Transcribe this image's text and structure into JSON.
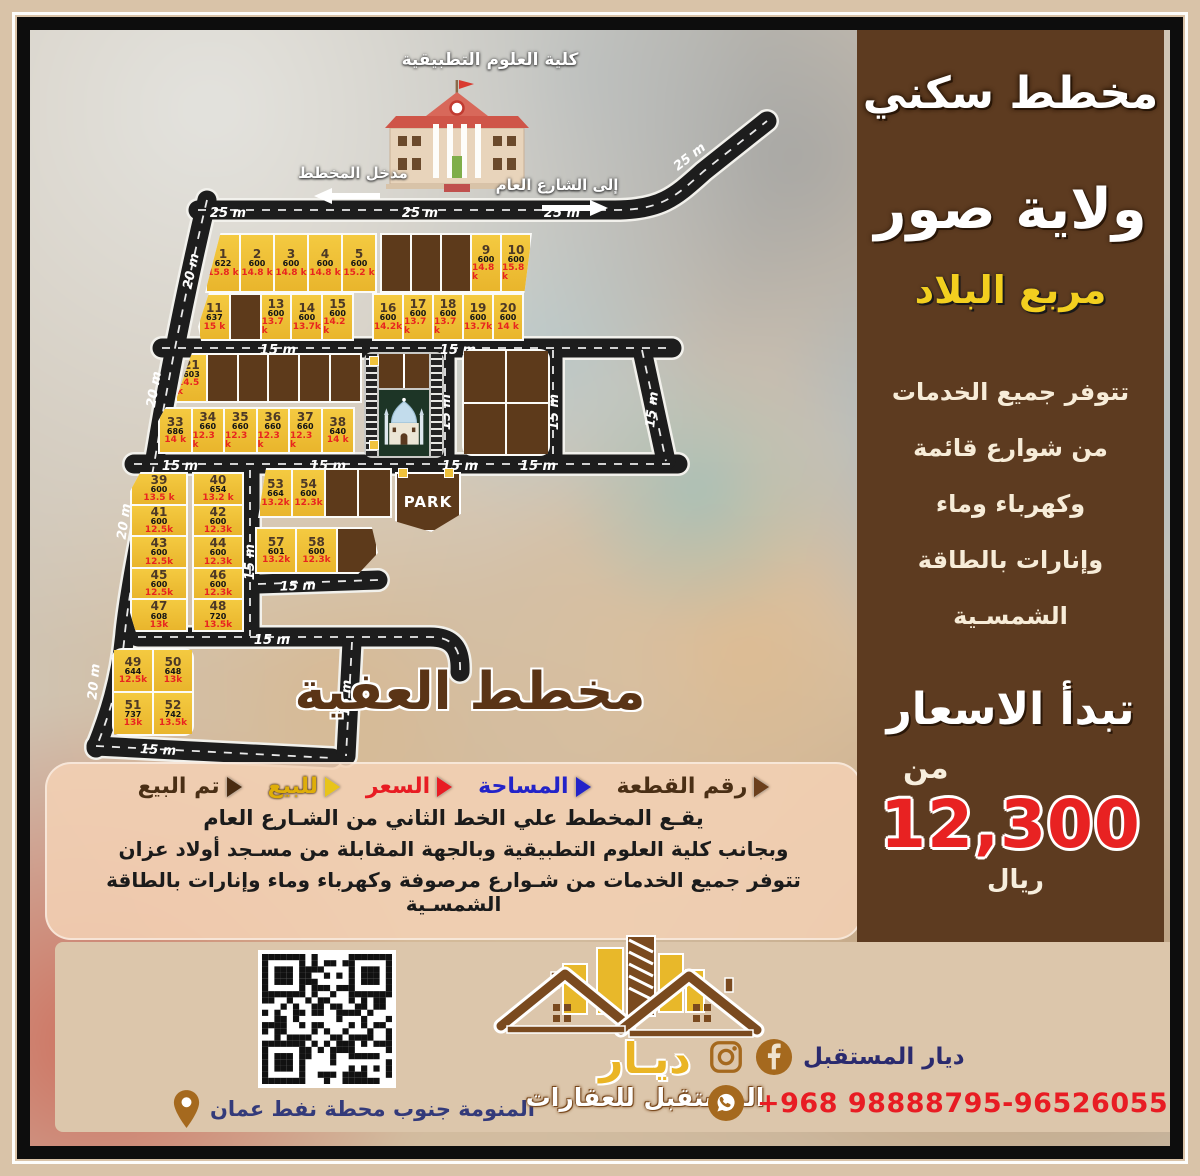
{
  "colors": {
    "frame": "#d9c3a8",
    "sidebar_brown": "#5d3b20",
    "plot_yellow": "#f0c23c",
    "sold_brown": "#5d3a1b",
    "price_red": "#e8251f",
    "area_blue": "#2323c8",
    "footer_beige": "#dcc6ab",
    "accent_yellow": "#f2cf1f"
  },
  "map": {
    "college_label": "كلية العلوم التطبيقية",
    "entrance_label": "مدخل المخطط",
    "street_label": "إلى الشارع العام",
    "park_label": "PARK",
    "title": "مخطط العفية"
  },
  "roads": {
    "r25": "25 m",
    "r20": "20 m",
    "r15": "15 m"
  },
  "blocks": {
    "a1": [
      {
        "no": "1",
        "area": "622",
        "price": "15.8 k"
      },
      {
        "no": "2",
        "area": "600",
        "price": "14.8 k"
      },
      {
        "no": "3",
        "area": "600",
        "price": "14.8 k"
      },
      {
        "no": "4",
        "area": "600",
        "price": "14.8 k"
      },
      {
        "no": "5",
        "area": "600",
        "price": "15.2 k"
      }
    ],
    "a2": [
      {
        "sold": true
      },
      {
        "sold": true
      },
      {
        "sold": true
      },
      {
        "no": "9",
        "area": "600",
        "price": "14.8 k"
      },
      {
        "no": "10",
        "area": "600",
        "price": "15.8 k"
      }
    ],
    "b1": [
      {
        "no": "11",
        "area": "637",
        "price": "15 k"
      },
      {
        "sold": true
      },
      {
        "no": "13",
        "area": "600",
        "price": "13.7 k"
      },
      {
        "no": "14",
        "area": "600",
        "price": "13.7k"
      },
      {
        "no": "15",
        "area": "600",
        "price": "14.2 k"
      }
    ],
    "b2": [
      {
        "no": "16",
        "area": "600",
        "price": "14.2k"
      },
      {
        "no": "17",
        "area": "600",
        "price": "13.7 k"
      },
      {
        "no": "18",
        "area": "600",
        "price": "13.7 k"
      },
      {
        "no": "19",
        "area": "600",
        "price": "13.7k"
      },
      {
        "no": "20",
        "area": "600",
        "price": "14 k"
      }
    ],
    "c": [
      {
        "no": "21",
        "area": "603",
        "price": "14.5 k"
      },
      {
        "sold": true
      },
      {
        "sold": true
      },
      {
        "sold": true
      },
      {
        "sold": true
      },
      {
        "sold": true
      }
    ],
    "d": [
      {
        "no": "33",
        "area": "686",
        "price": "14 k"
      },
      {
        "no": "34",
        "area": "660",
        "price": "12.3 k"
      },
      {
        "no": "35",
        "area": "660",
        "price": "12.3 k"
      },
      {
        "no": "36",
        "area": "660",
        "price": "12.3 k"
      },
      {
        "no": "37",
        "area": "660",
        "price": "12.3 k"
      },
      {
        "no": "38",
        "area": "640",
        "price": "14 k"
      }
    ],
    "f": [
      {
        "sold": true
      },
      {
        "sold": true
      },
      {
        "sold": true
      },
      {
        "sold": true
      }
    ],
    "g": [
      {
        "no": "39",
        "area": "600",
        "price": "13.5 k"
      },
      {
        "no": "41",
        "area": "600",
        "price": "12.5k"
      },
      {
        "no": "43",
        "area": "600",
        "price": "12.5k"
      },
      {
        "no": "45",
        "area": "600",
        "price": "12.5k"
      },
      {
        "no": "47",
        "area": "608",
        "price": "13k"
      }
    ],
    "h": [
      {
        "no": "40",
        "area": "654",
        "price": "13.2 k"
      },
      {
        "no": "42",
        "area": "600",
        "price": "12.3k"
      },
      {
        "no": "44",
        "area": "600",
        "price": "12.3k"
      },
      {
        "no": "46",
        "area": "600",
        "price": "12.3k"
      },
      {
        "no": "48",
        "area": "720",
        "price": "13.5k"
      }
    ],
    "i": [
      {
        "no": "53",
        "area": "664",
        "price": "13.2k"
      },
      {
        "no": "54",
        "area": "600",
        "price": "12.3k"
      },
      {
        "sold": true
      },
      {
        "sold": true
      }
    ],
    "j": [
      {
        "no": "57",
        "area": "601",
        "price": "13.2k"
      },
      {
        "no": "58",
        "area": "600",
        "price": "12.3k"
      },
      {
        "sold": true
      }
    ],
    "k": [
      {
        "no": "49",
        "area": "644",
        "price": "12.5k"
      },
      {
        "no": "50",
        "area": "648",
        "price": "13k"
      },
      {
        "no": "51",
        "area": "737",
        "price": "13k"
      },
      {
        "no": "52",
        "area": "742",
        "price": "13.5k"
      }
    ]
  },
  "legend": {
    "items": [
      {
        "label": "رقم القطعة",
        "color": "#4a2f15"
      },
      {
        "label": "المساحة",
        "color": "#2323c8"
      },
      {
        "label": "السعر",
        "color": "#e81c23"
      },
      {
        "label": "للبيع",
        "color": "#dfae09"
      },
      {
        "label": "تم البيع",
        "color": "#4a2f15"
      }
    ]
  },
  "description": {
    "line1": "يقـع المخطط علي الخط الثاني من الشـارع العام",
    "line2": "وبجانب كلية العلوم التطبيقية وبالجهة المقابلة من مسـجد أولاد عزان",
    "line3": "تتوفر جميع الخدمات من شـوارع مرصوفة وكهرباء وماء وإنارات بالطاقة الشمسـية"
  },
  "sidebar": {
    "title1": "مخطط سكني",
    "title2": "ولاية صور",
    "title3": "مربع البلاد",
    "svc1": "تتوفر جميع الخدمات",
    "svc2": "من شوارع قائمة",
    "svc3": "وكهرباء وماء",
    "svc4": "وإنارات بالطاقة الشمسـية",
    "prices_title": "تبدأ الاسعار",
    "from": "من",
    "price": "12,300",
    "currency": "ريال"
  },
  "footer": {
    "location": "المنومة جنوب محطة نفط عمان",
    "brand_name": "ديار المستقبل",
    "phone": "+968  98888795-96526055",
    "logo_line1": "ديـار",
    "logo_line2": "المستقبل للعقارات"
  }
}
